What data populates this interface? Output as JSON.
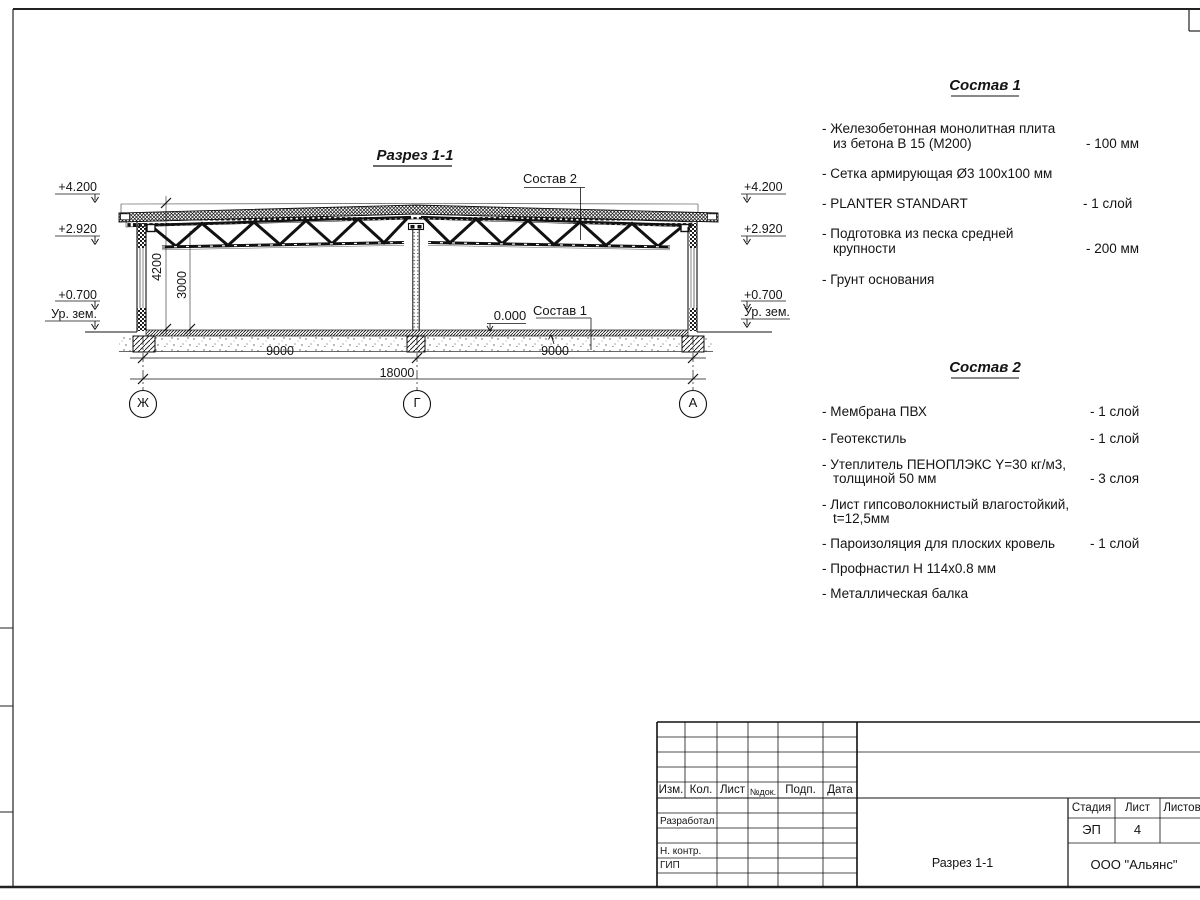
{
  "drawing": {
    "title": "Разрез 1-1",
    "labels": {
      "sostav1_ref": "Состав 1",
      "sostav2_ref": "Состав 2",
      "zero_mark": "0.000"
    },
    "elevations": {
      "roof": "+4.200",
      "truss": "+2.920",
      "plinth": "+0.700",
      "ground": "Ур. зем."
    },
    "dimensions": {
      "span_left": "9000",
      "span_right": "9000",
      "total": "18000",
      "height_total": "4200",
      "height_clear": "3000"
    },
    "axes": [
      "Ж",
      "Г",
      "А"
    ]
  },
  "sostav1": {
    "title": "Состав 1",
    "items": [
      {
        "line1": "- Железобетонная  монолитная плита",
        "line2": "из бетона В 15 (М200)",
        "value": "- 100 мм"
      },
      {
        "line1": "- Сетка армирующая Ø3 100х100 мм"
      },
      {
        "line1": "- PLANTER STANDART",
        "value": "-  1 слой"
      },
      {
        "line1": "- Подготовка из песка средней",
        "line2": "крупности",
        "value": "- 200 мм"
      },
      {
        "line1": "- Грунт основания"
      }
    ]
  },
  "sostav2": {
    "title": "Состав 2",
    "items": [
      {
        "line1": "- Мембрана ПВХ",
        "value": "- 1 слой"
      },
      {
        "line1": "- Геотекстиль",
        "value": "- 1 слой"
      },
      {
        "line1": "- Утеплитель ПЕНОПЛЭКС Y=30 кг/м3,",
        "line2": "толщиной 50 мм",
        "value": "- 3 слоя"
      },
      {
        "line1": "- Лист гипсоволокнистый влагостойкий,",
        "line2": "t=12,5мм"
      },
      {
        "line1": "- Пароизоляция для плоских кровель",
        "value": "- 1 слой"
      },
      {
        "line1": "- Профнастил Н 114х0.8 мм"
      },
      {
        "line1": "- Металлическая балка"
      }
    ]
  },
  "titleblock": {
    "header": {
      "izm": "Изм.",
      "kol": "Кол.",
      "list": "Лист",
      "ndok": "№док.",
      "podp": "Подп.",
      "data": "Дата"
    },
    "rows": {
      "razrabotal": "Разработал",
      "nkontr": "Н. контр.",
      "gip": "ГИП"
    },
    "stage_label": "Стадия",
    "sheet_label": "Лист",
    "sheets_label": "Листов",
    "stage_value": "ЭП",
    "sheet_value": "4",
    "doc_title": "Разрез 1-1",
    "company": "ООО \"Альянс\""
  }
}
